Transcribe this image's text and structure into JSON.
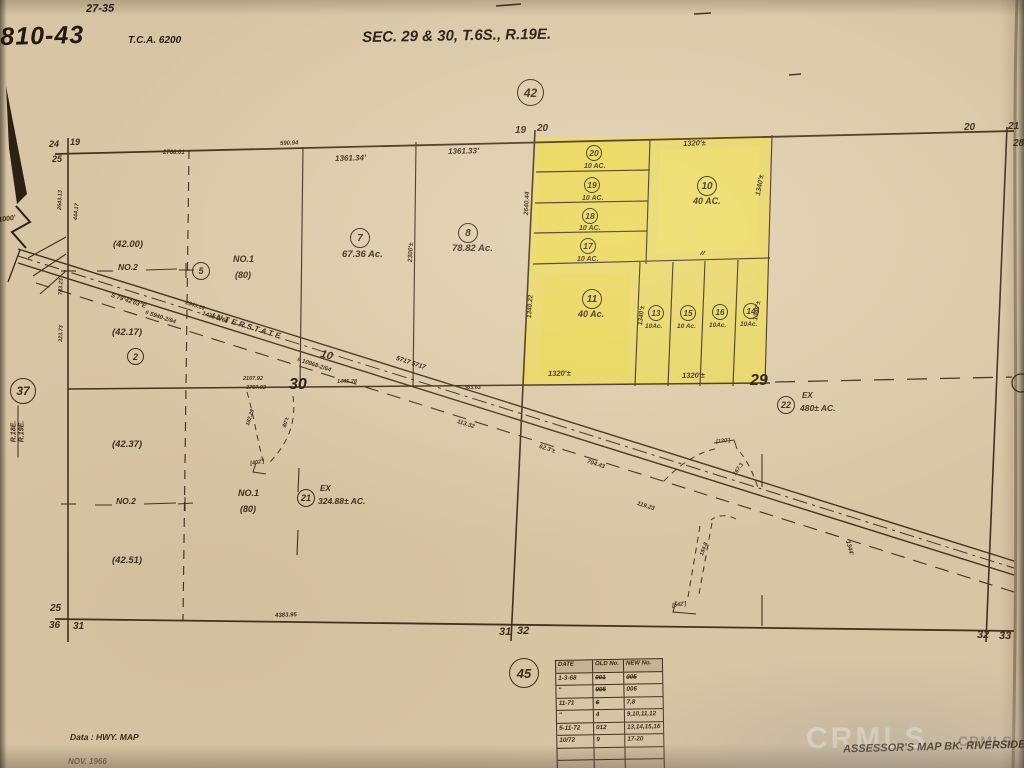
{
  "header": {
    "note": "27-35",
    "book": "810-43",
    "tca": "T.C.A. 6200",
    "title": "SEC. 29 & 30, T.6S., R.19E."
  },
  "circles": {
    "top": "42",
    "bottom": "45",
    "c37": "37",
    "c5": "5",
    "c7": "7",
    "c8": "8",
    "c2": "2",
    "c21": "21",
    "c22": "22",
    "c20": "20",
    "c19": "19",
    "c18": "18",
    "c17": "17",
    "c10": "10",
    "c11": "11",
    "c13": "13",
    "c15": "15",
    "c16": "16",
    "c14": "14"
  },
  "acreage": {
    "p7": "67.36 Ac.",
    "p8": "78.82 Ac.",
    "p20": "10 AC.",
    "p19": "10 AC.",
    "p18": "10 AC.",
    "p17": "10 AC.",
    "p10": "40 AC.",
    "p11": "40 Ac.",
    "p13": "10Ac.",
    "p15": "10 Ac.",
    "p16": "10Ac.",
    "p14": "10Ac.",
    "p21_ex": "EX",
    "p21": "324.88± AC.",
    "p22_ex": "EX",
    "p22": "480± AC."
  },
  "values": {
    "v42_00": "(42.00)",
    "v42_17": "(42.17)",
    "v42_37": "(42.37)",
    "v42_51": "(42.51)"
  },
  "routes": {
    "no1_a": "NO.1",
    "no1_a_sub": "(80)",
    "no1_b": "NO.1",
    "no1_b_sub": "(80)",
    "no2_a": "NO.2",
    "no2_b": "NO.2",
    "interstate": "INTERSTATE",
    "route_num": "10"
  },
  "sections": {
    "s30": "30",
    "s29": "29"
  },
  "corners": {
    "tl_24": "24",
    "tl_19": "19",
    "tl_25": "25",
    "tc_19": "19",
    "tc_20": "20",
    "tr_20": "20",
    "tr_21": "21",
    "tr_28": "28",
    "bl_25": "25",
    "bl_36": "36",
    "bl_31": "31",
    "bc_31": "31",
    "bc_32": "32",
    "br_32": "32",
    "br_33": "33"
  },
  "margin": {
    "scale": "1000'",
    "r18": "R.18E.",
    "r19": "R.19E."
  },
  "dims": {
    "d7_top": "1361.34'",
    "d8_top": "1361.33'",
    "d10_top": "1320'±",
    "d10_right": "1340'±",
    "d_2640": "2640.44",
    "d_1340_22": "1340.22",
    "d_2300": "2300'±",
    "d11_right": "1340'±",
    "d14_right": "1340'±",
    "d11_bot": "1320'±",
    "d16_bot": "1320'±",
    "ditto": "〃",
    "d_2768": "2768.01",
    "d_590": "590.94",
    "d_2643l": "2643.13",
    "d_743": "743.23",
    "d_323": "323.73",
    "d_444": "444.17",
    "d_4383": "4383.95",
    "d_2107": "2107.92",
    "d_3797": "3797.92",
    "d_1445": "1445.28",
    "d_2643": "2643.16",
    "d_363": "363.63"
  },
  "road_notes": {
    "bearing": "S 79°42'03\"E",
    "ref1": "# 5940-2/64",
    "ref2": "1435-1/68",
    "ref3": "# 10968-2/64",
    "sta": "5717  5717",
    "n113": "113.32",
    "n62": "62.3'±",
    "n704": "704.43",
    "n119": "119.23",
    "n154": "154.8",
    "n1344": "1344'",
    "n167": "167.3",
    "r_l1": "182.28",
    "r_l2": "80'±",
    "r_l3": "[402']",
    "r_r1": "[120']",
    "r_r2": "[542']"
  },
  "table": {
    "headers": [
      "DATE",
      "OLD No.",
      "NEW No."
    ],
    "rows": [
      [
        "1-3-68",
        "001",
        "005"
      ],
      [
        "\"",
        "005",
        "006"
      ],
      [
        "11-71",
        "6",
        "7,8"
      ],
      [
        "\"",
        "4",
        "9,10,11,12"
      ],
      [
        "5-11-72",
        "012",
        "13,14,15,16"
      ],
      [
        "10/72",
        "9",
        "17-20"
      ],
      [
        "",
        "",
        ""
      ],
      [
        "",
        "",
        ""
      ],
      [
        "",
        "",
        ""
      ]
    ]
  },
  "footer": {
    "data_note": "Data : HWY. MAP",
    "date_note": "NOV. 1966",
    "assessor": "ASSESSOR'S MAP BK. RIVERSIDE",
    "wm1": "CRMLS",
    "wm2": "CRMLS"
  }
}
